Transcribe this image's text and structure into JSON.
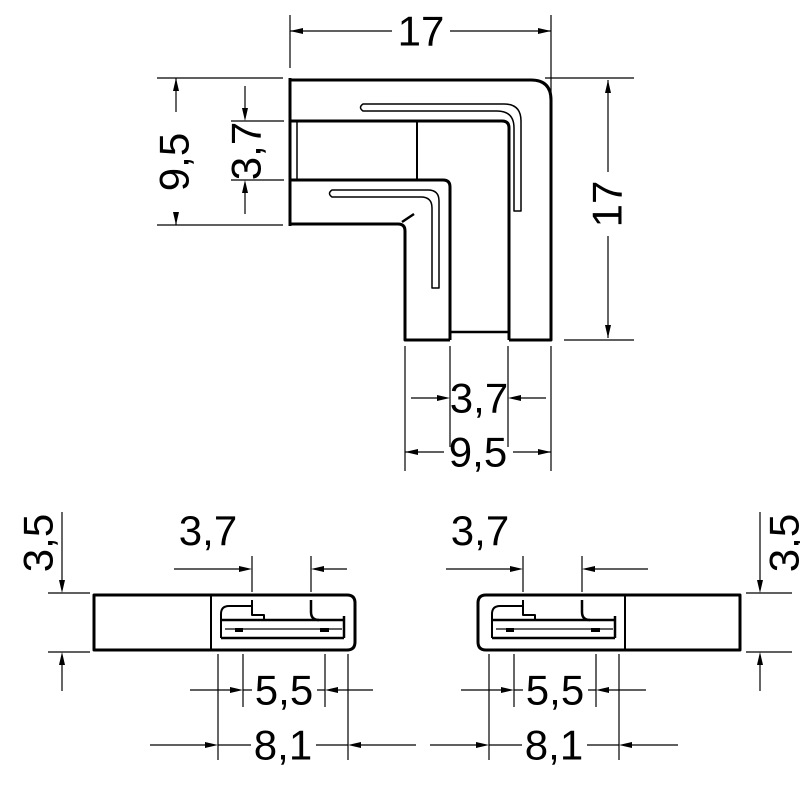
{
  "colors": {
    "line": "#000000",
    "background": "#ffffff"
  },
  "views": {
    "front": {
      "dim_total_width": "17",
      "dim_total_height": "17",
      "dim_arm_height": "9,5",
      "dim_slot_height": "3,7",
      "dim_slot_width": "3,7",
      "dim_arm_width": "9,5"
    },
    "side_left": {
      "dim_thickness": "3,5",
      "dim_slot_width": "3,7",
      "dim_tongue_length": "5,5",
      "dim_insert_length": "8,1"
    },
    "side_right": {
      "dim_thickness": "3,5",
      "dim_slot_width": "3,7",
      "dim_tongue_length": "5,5",
      "dim_insert_length": "8,1"
    }
  }
}
